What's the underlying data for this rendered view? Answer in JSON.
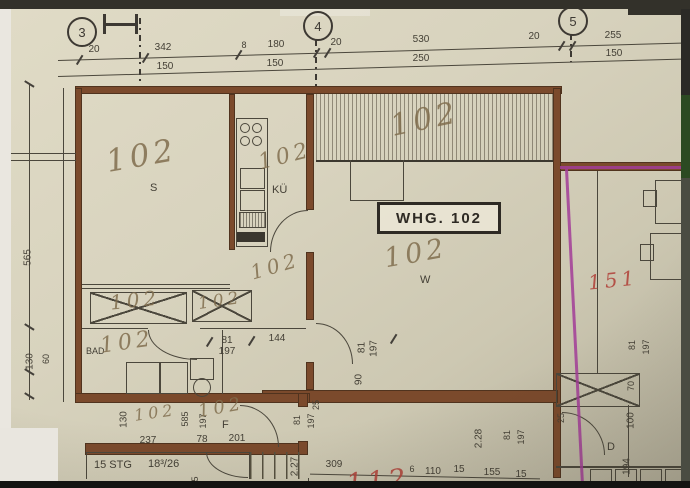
{
  "axes": {
    "a3": "3",
    "a4": "4",
    "a5": "5"
  },
  "top_dims": {
    "r1": [
      "20",
      "342",
      "8",
      "180",
      "20",
      "530",
      "20",
      "255"
    ],
    "r2": [
      "150",
      "150",
      "250",
      "150"
    ]
  },
  "left_dims": {
    "v565": "565",
    "v130": "130",
    "v60": "60"
  },
  "whg_label": "WHG. 102",
  "rooms": {
    "s": "S",
    "ku": "KÜ",
    "w": "W",
    "bad": "BAD",
    "f": "F",
    "d": "D"
  },
  "hand_marks": {
    "s": "102",
    "ku": "102",
    "balcony": "102",
    "w": "102",
    "bad": "102",
    "ward1": "102",
    "ward2": "102",
    "hall": "102",
    "f1": "102",
    "f2": "102",
    "apt151": "151",
    "apt112": "112"
  },
  "stairs": {
    "steps": "15 STG",
    "ratio": "18³/26",
    "extra": "5"
  },
  "dims": {
    "hall81": "81",
    "hall197": "197",
    "hall144": "144",
    "wd81": "81",
    "wd197": "197",
    "wd90": "90",
    "ent81": "81",
    "ent197": "197",
    "ent25": "25",
    "v227": "2.27",
    "f130": "130",
    "f585": "585",
    "f197": "197",
    "f237": "237",
    "f78": "78",
    "f201": "201",
    "b309": "309",
    "b6": "6",
    "b110": "110",
    "b15a": "15",
    "b155": "155",
    "b15b": "15",
    "v228": "2.28",
    "st81": "81",
    "st197": "197",
    "n81": "81",
    "n197": "197",
    "n70": "70",
    "n100": "100",
    "n194": "194",
    "n25": "25"
  },
  "colors": {
    "wall_brown": "#7b4a2c",
    "marker_magenta": "#a23c98",
    "hand_red": "#b0423a",
    "pencil": "#806d4e",
    "paper": "#d8d3be"
  }
}
